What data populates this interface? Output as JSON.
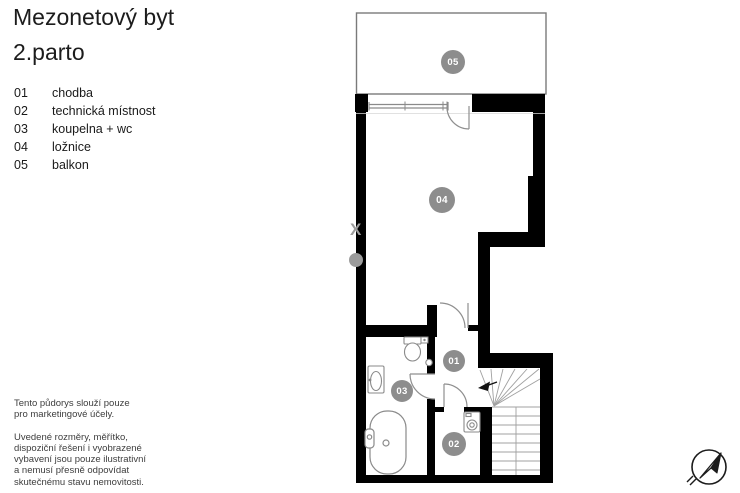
{
  "title": {
    "line1": "Mezonetový byt",
    "line2": "2.parto"
  },
  "legend": [
    {
      "num": "01",
      "label": "chodba"
    },
    {
      "num": "02",
      "label": "technická místnost"
    },
    {
      "num": "03",
      "label": "koupelna + wc"
    },
    {
      "num": "04",
      "label": "ložnice"
    },
    {
      "num": "05",
      "label": "balkon"
    }
  ],
  "plan": {
    "markers": [
      {
        "num": "01"
      },
      {
        "num": "02"
      },
      {
        "num": "03"
      },
      {
        "num": "04"
      },
      {
        "num": "05"
      }
    ]
  },
  "disclaimer": {
    "para1": [
      "Tento půdorys slouží pouze",
      "pro marketingové účely."
    ],
    "para2": [
      "Uvedené rozměry, měřítko,",
      "dispoziční řešení i vyobrazené",
      "vybavení jsou pouze ilustrativní",
      "a nemusí přesně odpovídat",
      "skutečnému stavu nemovitosti."
    ]
  },
  "watermark": {
    "char": "X"
  },
  "colors": {
    "wall": "#000000",
    "marker": "#8d8d8d",
    "thin_line": "#8a8a8a",
    "stair_line": "#9a9a9a"
  }
}
